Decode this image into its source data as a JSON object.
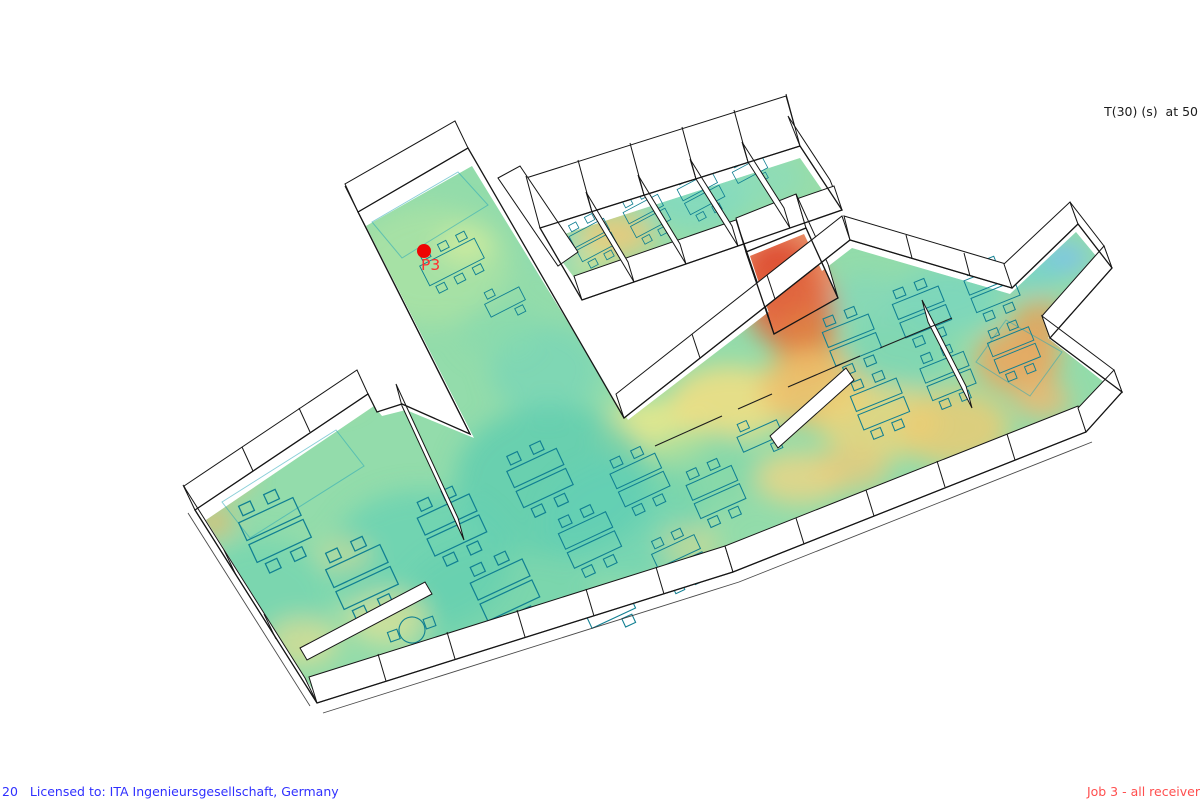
{
  "view": {
    "metric_label": "T(30) (s)  at 50",
    "marker": {
      "label": "P3"
    }
  },
  "footer": {
    "license_number": "20",
    "license_text": "Licensed to: ITA Ingenieursgesellschaft, Germany",
    "job_label": "Job 3 - all receiver"
  },
  "colors": {
    "background": "#ffffff",
    "license_text": "#3030ff",
    "job_text": "#ff4f4f",
    "metric_text": "#1c1c1c",
    "marker": "#ee0404",
    "walls": "#161616",
    "furniture": "#107f92",
    "heat_cold": "#7cc3e8",
    "heat_cool": "#5fd0b4",
    "heat_mid_green": "#94dcaa",
    "heat_warm_yellow": "#eede84",
    "heat_hot_orange": "#f0a860",
    "heat_max_red": "#dd4730"
  }
}
